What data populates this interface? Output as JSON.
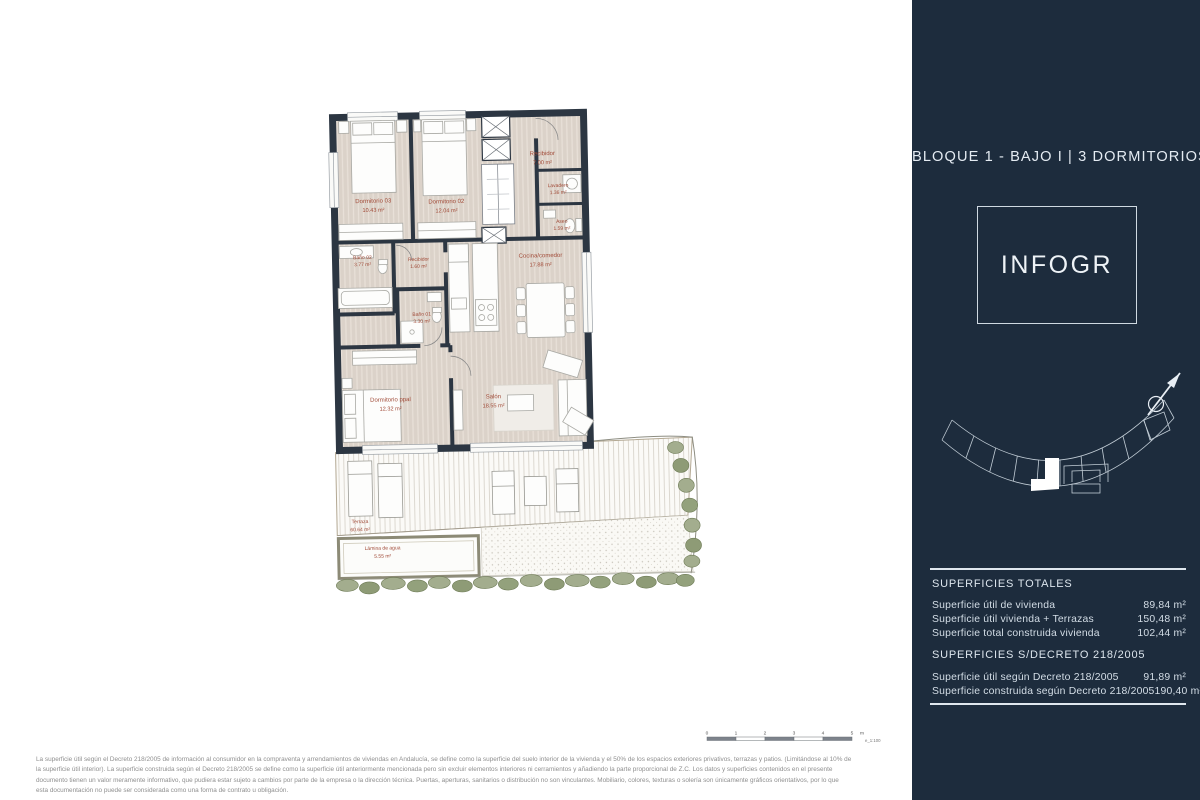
{
  "sidebar": {
    "title": "BLOQUE 1 - BAJO I | 3 DORMITORIOS",
    "logo": "INFOGR",
    "totals": {
      "heading": "SUPERFICIES TOTALES",
      "rows": [
        {
          "label": "Superficie útil de vivienda",
          "value": "89,84 m²"
        },
        {
          "label": "Superficie útil vivienda + Terrazas",
          "value": "150,48 m²"
        },
        {
          "label": "Superficie total construida vivienda",
          "value": "102,44 m²"
        }
      ]
    },
    "decreto": {
      "heading": "SUPERFICIES S/DECRETO 218/2005",
      "rows": [
        {
          "label": "Superficie útil según Decreto 218/2005",
          "value": "91,89 m²"
        },
        {
          "label": "Superficie construida según Decreto 218/2005",
          "value": "190,40 m²"
        }
      ]
    }
  },
  "plan": {
    "rooms": [
      {
        "name": "Dormitorio 03",
        "area": "10.43 m²"
      },
      {
        "name": "Dormitorio 02",
        "area": "12.04 m²"
      },
      {
        "name": "Recibidor",
        "area": "7.00 m²"
      },
      {
        "name": "Lavadero",
        "area": "1.36 m²"
      },
      {
        "name": "Aseo",
        "area": "1.59 m²"
      },
      {
        "name": "Baño 02",
        "area": "3.77 m²"
      },
      {
        "name": "Recibidor",
        "area": "1.60 m²"
      },
      {
        "name": "Baño 01",
        "area": "3.30 m²"
      },
      {
        "name": "Cocina/comedor",
        "area": "17.88 m²"
      },
      {
        "name": "Dormitorio ppal",
        "area": "12.32 m²"
      },
      {
        "name": "Salón",
        "area": "18.55 m²"
      },
      {
        "name": "Terraza",
        "area": "60.64 m²"
      },
      {
        "name": "Lámina de agua",
        "area": "5.55 m²"
      }
    ]
  },
  "scalebar": {
    "ticks": [
      "0",
      "1",
      "2",
      "3",
      "4",
      "5"
    ],
    "unit": "m",
    "scale_label": "e_1:100"
  },
  "footer": {
    "lines": [
      "La superficie útil según el Decreto 218/2005 de información al consumidor en la compraventa y arrendamientos de viviendas en Andalucía, se define como la superficie del suelo interior de la vivienda y el 50% de los espacios exteriores privativos, terrazas y patios. (Limitándose al 10% de",
      "la superficie útil interior). La superficie construida según el Decreto 218/2005 se define como la superficie útil anteriormente mencionada pero sin excluir elementos interiores ni cerramientos y añadiendo la parte proporcional de Z.C. Los datos y superficies contenidos en el presente",
      "documento tienen un valor meramente informativo, que pudiera estar sujeto a cambios por parte de la empresa o la dirección técnica. Puertas, aperturas, sanitarios o distribución no son vinculantes. Mobiliario, colores, texturas o solería son únicamente gráficos orientativos, por lo que",
      "esta documentación no puede ser considerada como una forma de contrato u obligación."
    ]
  },
  "colors": {
    "sidebar_bg": "#1d2c3d",
    "sidebar_text": "#dde6ee",
    "plan_label": "#a14b38",
    "floor": "#dbd2c9",
    "wall": "#2c3642",
    "greenery": "#a3ad8e"
  }
}
